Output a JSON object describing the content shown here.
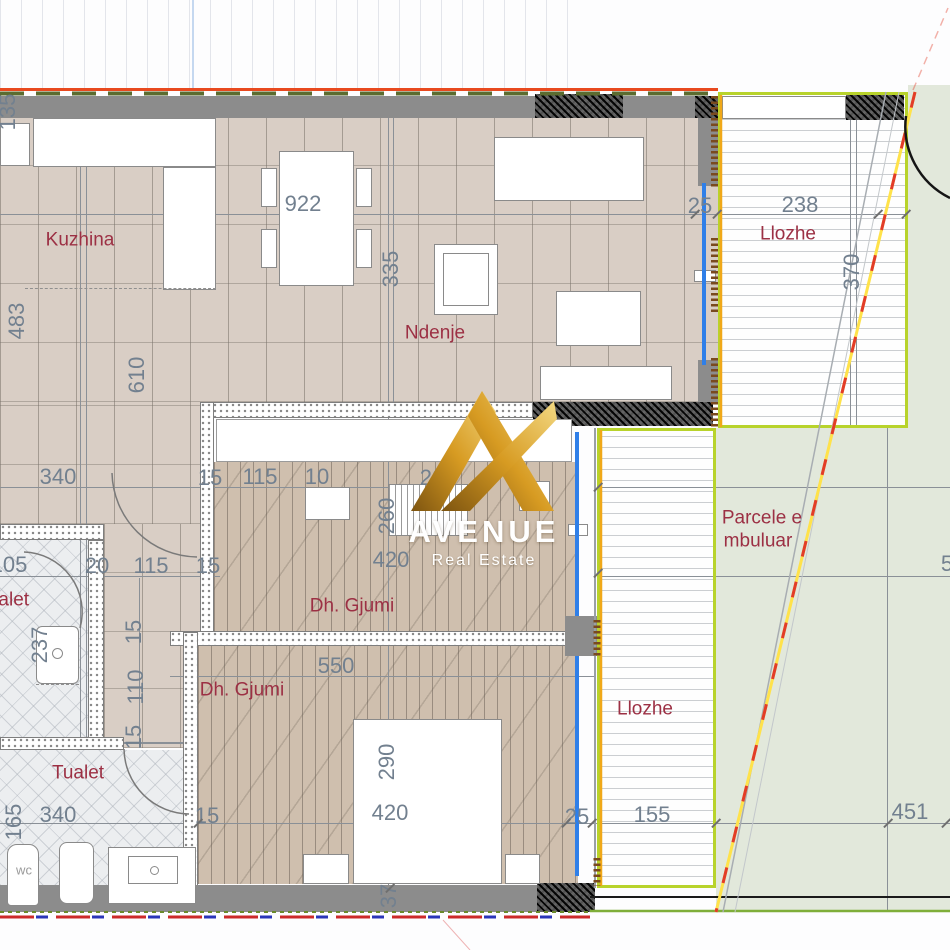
{
  "brand": {
    "name": "AVENUE",
    "tagline": "Real Estate"
  },
  "room_labels": [
    {
      "id": "kuzhina",
      "text": "Kuzhina",
      "x": 80,
      "y": 240
    },
    {
      "id": "ndenje",
      "text": "Ndenje",
      "x": 435,
      "y": 333
    },
    {
      "id": "llozhe-upper",
      "text": "Llozhe",
      "x": 788,
      "y": 234
    },
    {
      "id": "parcele-line1",
      "text": "Parcele e",
      "x": 762,
      "y": 518
    },
    {
      "id": "parcele-line2",
      "text": "mbuluar",
      "x": 758,
      "y": 541
    },
    {
      "id": "dh-gjumi-upper",
      "text": "Dh. Gjumi",
      "x": 352,
      "y": 606
    },
    {
      "id": "dh-gjumi-lower",
      "text": "Dh. Gjumi",
      "x": 242,
      "y": 690
    },
    {
      "id": "tualet-upper",
      "text": "Tualet",
      "x": 3,
      "y": 600
    },
    {
      "id": "tualet-lower",
      "text": "Tualet",
      "x": 78,
      "y": 773
    },
    {
      "id": "llozhe-lower",
      "text": "Llozhe",
      "x": 645,
      "y": 709
    },
    {
      "id": "wc",
      "text": "wc",
      "x": 24,
      "y": 870,
      "small": true
    }
  ],
  "dimensions": [
    {
      "t": "135",
      "x": 8,
      "y": 112,
      "v": 1
    },
    {
      "t": "922",
      "x": 303,
      "y": 204
    },
    {
      "t": "25",
      "x": 700,
      "y": 206
    },
    {
      "t": "238",
      "x": 800,
      "y": 205
    },
    {
      "t": "370",
      "x": 852,
      "y": 272,
      "v": 1
    },
    {
      "t": "335",
      "x": 391,
      "y": 269,
      "v": 1
    },
    {
      "t": "483",
      "x": 17,
      "y": 321,
      "v": 1
    },
    {
      "t": "610",
      "x": 137,
      "y": 375,
      "v": 1
    },
    {
      "t": "340",
      "x": 58,
      "y": 477
    },
    {
      "t": "15",
      "x": 210,
      "y": 478
    },
    {
      "t": "115",
      "x": 260,
      "y": 477
    },
    {
      "t": "10",
      "x": 317,
      "y": 477
    },
    {
      "t": "20",
      "x": 432,
      "y": 478
    },
    {
      "t": "105",
      "x": 9,
      "y": 565
    },
    {
      "t": "20",
      "x": 97,
      "y": 566
    },
    {
      "t": "115",
      "x": 151,
      "y": 566
    },
    {
      "t": "15",
      "x": 208,
      "y": 566
    },
    {
      "t": "260",
      "x": 387,
      "y": 516,
      "v": 1
    },
    {
      "t": "420",
      "x": 391,
      "y": 560
    },
    {
      "t": "237",
      "x": 40,
      "y": 645,
      "v": 1
    },
    {
      "t": "15",
      "x": 134,
      "y": 632,
      "v": 1
    },
    {
      "t": "110",
      "x": 136,
      "y": 687,
      "v": 1
    },
    {
      "t": "15",
      "x": 134,
      "y": 737,
      "v": 1
    },
    {
      "t": "550",
      "x": 336,
      "y": 666
    },
    {
      "t": "290",
      "x": 387,
      "y": 762,
      "v": 1
    },
    {
      "t": "165",
      "x": 14,
      "y": 822,
      "v": 1
    },
    {
      "t": "340",
      "x": 58,
      "y": 815
    },
    {
      "t": "15",
      "x": 207,
      "y": 816
    },
    {
      "t": "420",
      "x": 390,
      "y": 813
    },
    {
      "t": "25",
      "x": 577,
      "y": 817
    },
    {
      "t": "155",
      "x": 652,
      "y": 815
    },
    {
      "t": "451",
      "x": 910,
      "y": 812
    },
    {
      "t": "37",
      "x": 389,
      "y": 896,
      "v": 1
    },
    {
      "t": "5",
      "x": 947,
      "y": 564
    }
  ],
  "ticks": [
    [
      695,
      214
    ],
    [
      717,
      214
    ],
    [
      878,
      214
    ],
    [
      906,
      214
    ],
    [
      598,
      487
    ],
    [
      598,
      573
    ],
    [
      198,
      823
    ],
    [
      566,
      823
    ],
    [
      592,
      823
    ],
    [
      716,
      823
    ],
    [
      888,
      823
    ],
    [
      946,
      823
    ],
    [
      390,
      888
    ]
  ],
  "colors": {
    "boundary_red": "#e8491f",
    "boundary_green_dash": "#5b6c30",
    "parcel_line_yellow": "#ffe24a",
    "parcel_line_red": "#e23c28",
    "loggia_border": "#b8d32b",
    "loggia_inner_line": "#f0a818",
    "window_blue": "#2f7fe8",
    "wall_gray": "#8c8c8c",
    "dim_text": "#72808f",
    "room_text": "#9c3044",
    "logo_gold_dark": "#7d5410",
    "logo_gold_light": "#f3d983"
  }
}
